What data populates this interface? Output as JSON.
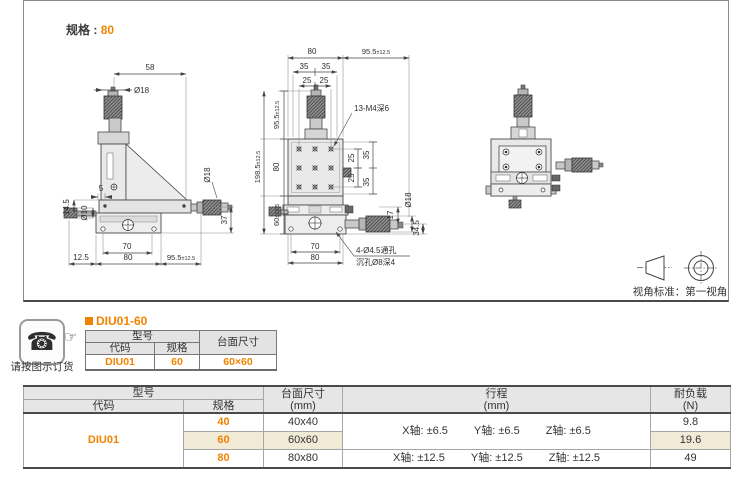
{
  "colors": {
    "accent": "#f08300",
    "highlight": "#f0ead6",
    "line": "#4d4d4d"
  },
  "spec": {
    "label": "规格 :",
    "value": "80"
  },
  "view_standard": "视角标准：第一视角",
  "order": {
    "caption": "请按图示订货"
  },
  "product": {
    "title": "DIU01-60"
  },
  "mini_table": {
    "model": "型号",
    "code": "代码",
    "spec": "规格",
    "size": "台面尺寸",
    "row": {
      "code": "DIU01",
      "spec": "60",
      "size": "60×60"
    }
  },
  "main_table": {
    "model": "型号",
    "code": "代码",
    "spec": "规格",
    "size_title": "台面尺寸",
    "size_unit": "(mm)",
    "travel_title": "行程",
    "travel_unit": "(mm)",
    "load_title": "耐负载",
    "load_unit": "(N)",
    "code_value": "DIU01",
    "rows": [
      {
        "spec": "40",
        "size": "40x40",
        "load": "9.8"
      },
      {
        "spec": "60",
        "size": "60x60",
        "load": "19.6"
      },
      {
        "spec": "80",
        "size": "80x80",
        "load": "49"
      }
    ],
    "travel_small": [
      "X轴: ±6.5",
      "Y轴: ±6.5",
      "Z轴: ±6.5"
    ],
    "travel_large": [
      "X轴: ±12.5",
      "Y轴: ±12.5",
      "Z轴: ±12.5"
    ]
  },
  "drawings": {
    "side_view": {
      "d58": "58",
      "dia18_top": "Ø18",
      "d5": "5",
      "d14_5": "14.5",
      "dia10": "Ø10",
      "d12_5": "12.5",
      "d70": "70",
      "d80": "80",
      "d95": {
        "v": "95.5",
        "tol": "±12.5"
      },
      "dia18_right": "Ø18",
      "d37": "37"
    },
    "front_view": {
      "d80_top": "80",
      "d95_top": {
        "v": "95.5",
        "tol": "±12.5"
      },
      "d35a": "35",
      "d35b": "35",
      "d25a": "25",
      "d25b": "25",
      "thread_label": "13-M4深6",
      "v95": {
        "v": "95.5",
        "tol": "±12.5"
      },
      "v80": "80",
      "v198": {
        "v": "198.5",
        "tol": "±12.5"
      },
      "v60": {
        "v": "60",
        "tol": "±12.5"
      },
      "r25a": "25",
      "r25b": "25",
      "r35a": "35",
      "r35b": "35",
      "d17": "17",
      "dia18": "Ø18",
      "d34_5": "34.5",
      "d70": "70",
      "d80_bot": "80",
      "hole_label_1": "4-Ø4.5通孔",
      "hole_label_2": "沉孔Ø8深4"
    }
  }
}
